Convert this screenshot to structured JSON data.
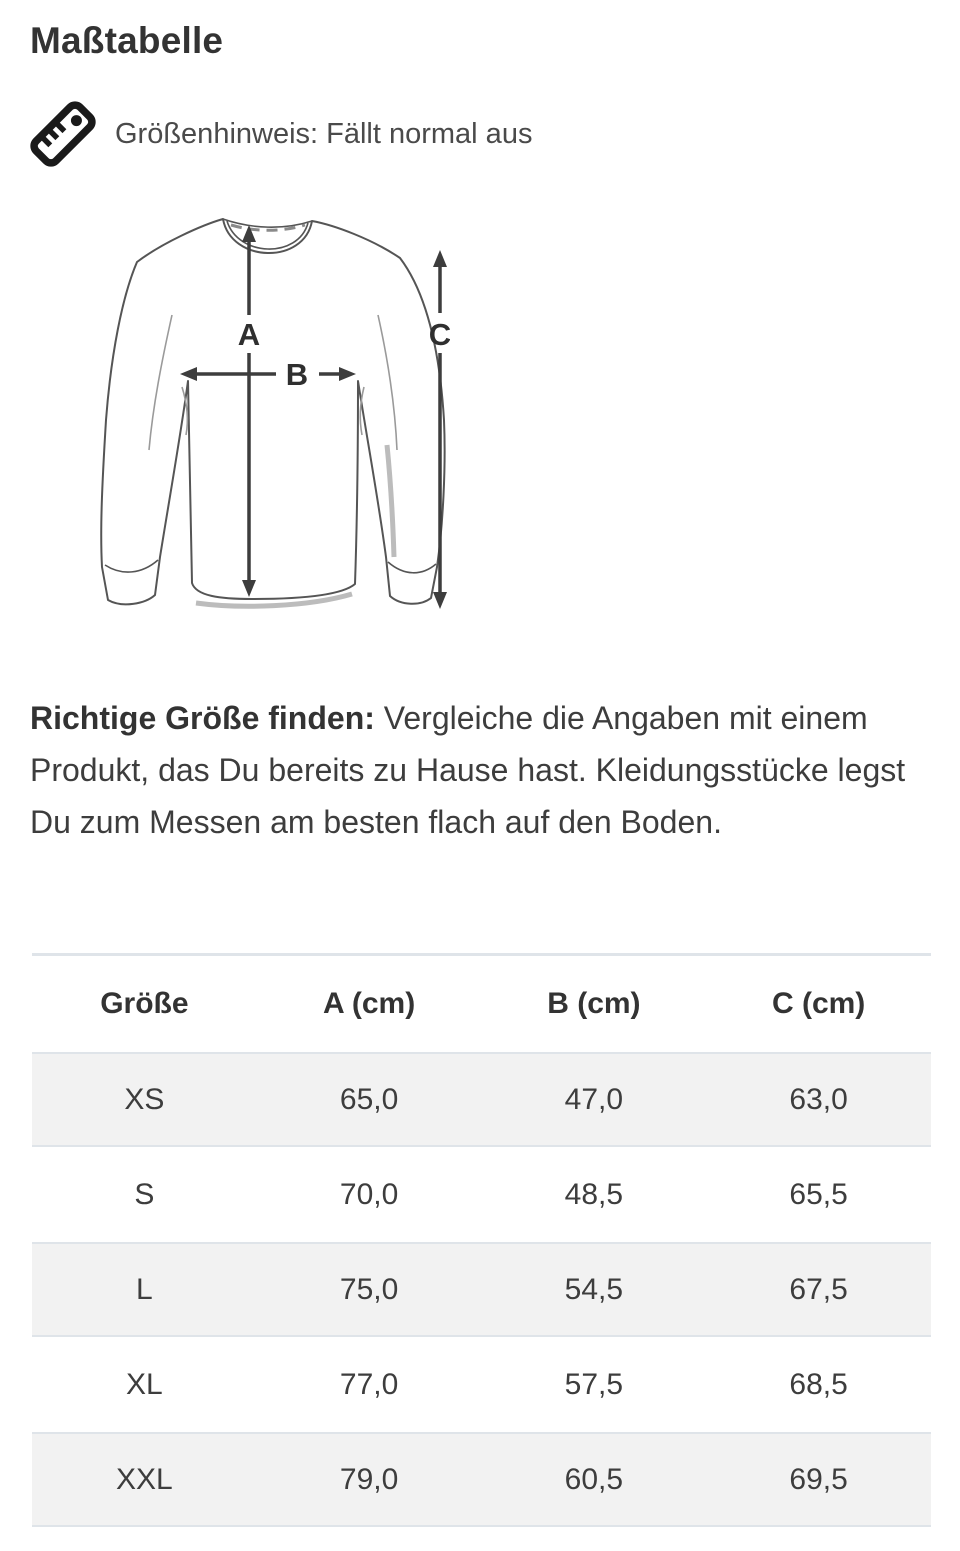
{
  "page": {
    "title": "Maßtabelle"
  },
  "size_hint": {
    "icon": "ruler-icon",
    "text": "Größenhinweis: Fällt normal aus"
  },
  "diagram": {
    "description": "long-sleeve-shirt-measurement-drawing",
    "labels": {
      "a": "A",
      "b": "B",
      "c": "C"
    }
  },
  "finder": {
    "lead": "Richtige Größe finden:",
    "text": " Vergleiche die Angaben mit einem Produkt, das Du bereits zu Hause hast. Kleidungsstücke legst Du zum Messen am besten flach auf den Boden."
  },
  "table": {
    "headers": [
      "Größe",
      "A (cm)",
      "B (cm)",
      "C (cm)"
    ],
    "rows": [
      {
        "size": "XS",
        "a": "65,0",
        "b": "47,0",
        "c": "63,0"
      },
      {
        "size": "S",
        "a": "70,0",
        "b": "48,5",
        "c": "65,5"
      },
      {
        "size": "L",
        "a": "75,0",
        "b": "54,5",
        "c": "67,5"
      },
      {
        "size": "XL",
        "a": "77,0",
        "b": "57,5",
        "c": "68,5"
      },
      {
        "size": "XXL",
        "a": "79,0",
        "b": "60,5",
        "c": "69,5"
      }
    ]
  },
  "colors": {
    "title_text": "#333333",
    "body_text": "#3d3d3d",
    "stripe_bg": "#f2f2f2",
    "table_border": "#dfe4e9",
    "drawing_outline": "#555555",
    "arrow": "#3d3d3d"
  }
}
